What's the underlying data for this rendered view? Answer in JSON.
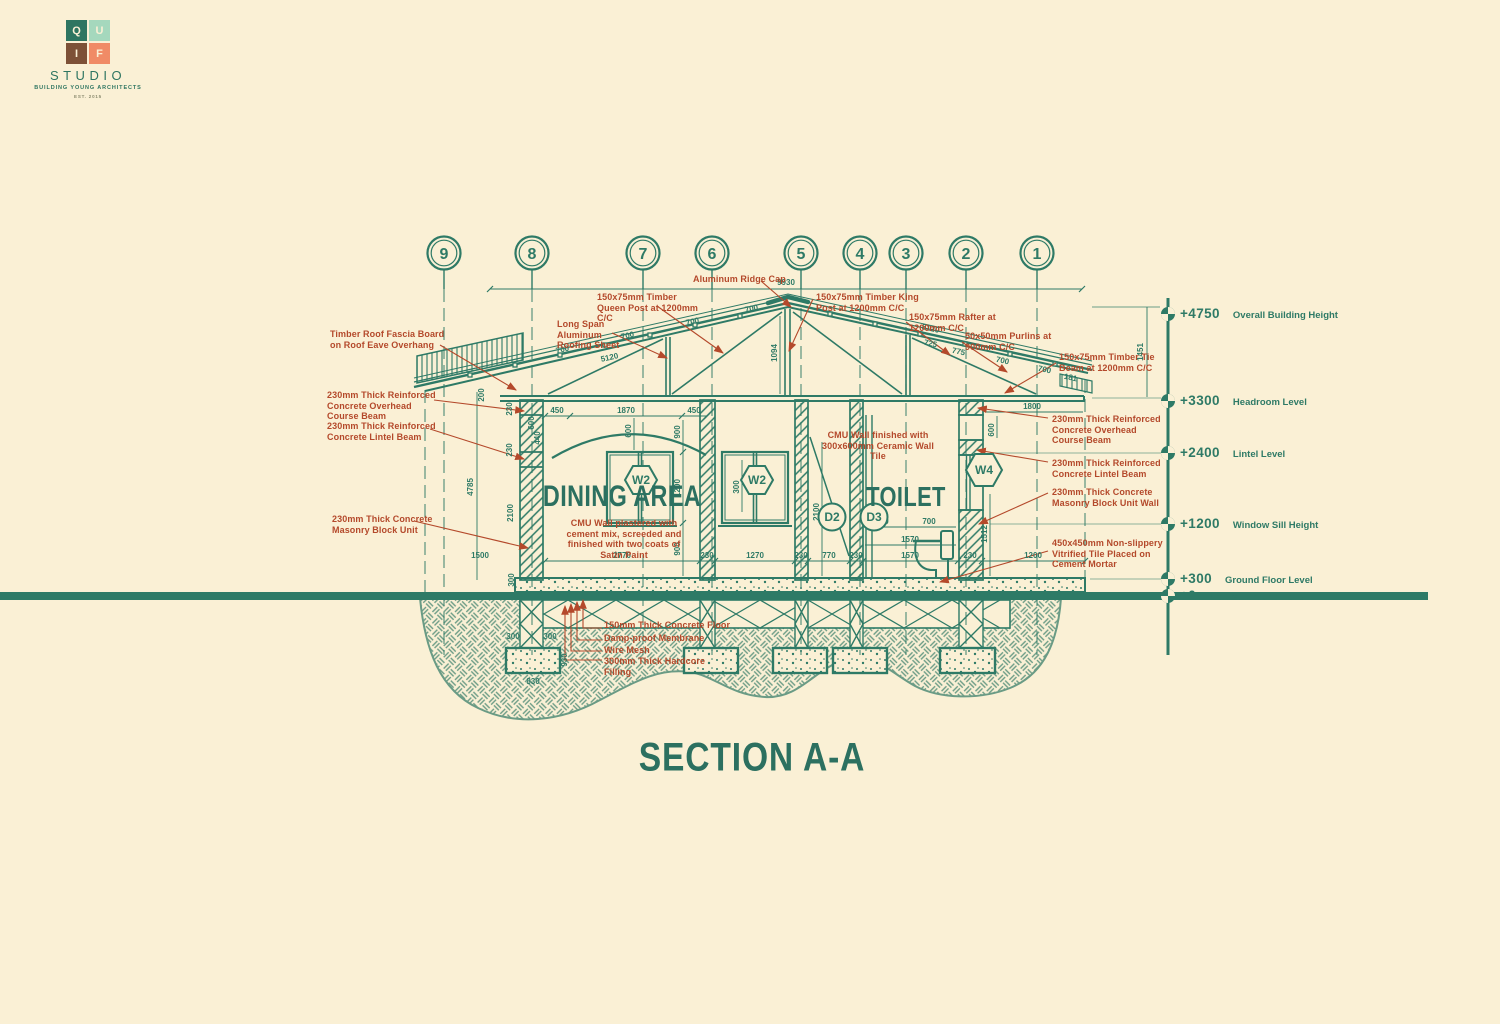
{
  "logo": {
    "letters": [
      "Q",
      "U",
      "I",
      "F"
    ],
    "studio": "STUDIO",
    "tagline": "BUILDING YOUNG ARCHITECTS",
    "est": "EST. 2015"
  },
  "title": "SECTION A-A",
  "grid": {
    "labels": [
      "9",
      "8",
      "7",
      "6",
      "5",
      "4",
      "3",
      "2",
      "1"
    ]
  },
  "levels": [
    {
      "value": "+4750",
      "label": "Overall Building Height"
    },
    {
      "value": "+3300",
      "label": "Headroom Level"
    },
    {
      "value": "+2400",
      "label": "Lintel Level"
    },
    {
      "value": "+1200",
      "label": "Window Sill Height"
    },
    {
      "value": "+300",
      "label": "Ground Floor Level"
    },
    {
      "value": "+0",
      "label": "Natural Ground Level"
    }
  ],
  "rooms": {
    "dining": "DINING AREA",
    "toilet": "TOILET"
  },
  "tags": {
    "w2a": "W2",
    "w2b": "W2",
    "w4": "W4",
    "d2": "D2",
    "d3": "D3"
  },
  "annotations": {
    "fascia": "Timber Roof Fascia Board on Roof Eave Overhang",
    "overhead_left": "230mm Thick Reinforced Concrete Overhead Course Beam",
    "lintel_left": "230mm Thick Reinforced Concrete Lintel Beam",
    "cmu_left": "230mm Thick Concrete Masonry Block Unit",
    "roofing": "Long Span Aluminum Roofing Sheet",
    "queen_post": "150x75mm Timber Queen Post at 1200mm C/C",
    "ridge_cap": "Aluminum Ridge Cap",
    "king_post": "150x75mm Timber King Post at 1200mm C/C",
    "rafter": "150x75mm Rafter at 1200mm C/C",
    "purlins": "50x50mm Purlins at 900mm C/C",
    "tie_beam": "150x75mm Timber Tie Beam at 1200mm C/C",
    "overhead_right": "230mm Thick Reinforced Concrete Overhead Course Beam",
    "lintel_right": "230mm Thick Reinforced Concrete Lintel Beam",
    "cmu_right": "230mm Thick Concrete Masonry Block Unit Wall",
    "tile": "450x450mm Non-slippery Vitrified Tile Placed on Cement Mortar",
    "ceramic": "CMU Wall finished with 300x600mm Ceramic Wall Tile",
    "plaster": "CMU Wall plastered with cement mix, screeded and finished with two coats of Satin Paint",
    "slab": "150mm Thick Concrete Floor",
    "membrane": "Damp-proof Membrane",
    "mesh": "Wire Mesh",
    "hardcore": "300mm Thick Hardcore Filling"
  },
  "dims": {
    "top": "9930",
    "rise": "1451",
    "king": "1094",
    "left_total": "4785",
    "left_stack": [
      "200",
      "230",
      "600",
      "440",
      "230",
      "2100",
      "300"
    ],
    "eave": "1500",
    "slope_left": [
      "700",
      "700",
      "700",
      "700",
      "5120"
    ],
    "slope_right": [
      "5120",
      "725",
      "775",
      "700",
      "700",
      "181"
    ],
    "dining_top": [
      "450",
      "1870",
      "450"
    ],
    "arch": "600",
    "dining_v": [
      "900",
      "1200",
      "900"
    ],
    "bay": "300",
    "toilet_top": [
      "670",
      "700"
    ],
    "toilet_mid": "1570",
    "right_h": "1800",
    "right_v1": "600",
    "right_v2": "1512",
    "toilet_height": "2100",
    "bottom": [
      "2770",
      "230",
      "1270",
      "230",
      "770",
      "230",
      "1570",
      "230",
      "1200"
    ],
    "footing": [
      "300",
      "300",
      "930",
      "830"
    ]
  },
  "colors": {
    "background": "#FAF0D5",
    "line_green": "#2E7A66",
    "text_green": "#2C7060",
    "annotation_red": "#B4492B",
    "logo_teal": "#2E7561",
    "logo_mint": "#A5D8BD",
    "logo_brown": "#7D5137",
    "logo_salmon": "#F08B66"
  }
}
